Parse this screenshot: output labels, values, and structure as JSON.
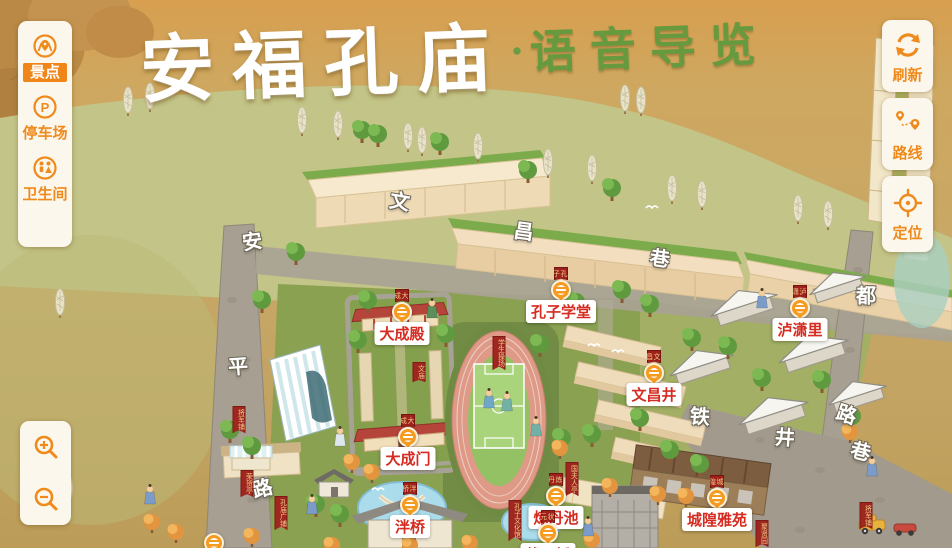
{
  "title": {
    "main": "安福孔庙",
    "separator": "·",
    "sub": "语音导览"
  },
  "colors": {
    "accent_orange": "#f08519",
    "poi_text_red": "#d52b20",
    "banner_red": "#9e211b",
    "title_white": "#ffffff",
    "title_green": "#679a3e",
    "paper_tan": "#c8a866"
  },
  "sidebar": {
    "items": [
      {
        "id": "scenic",
        "label": "景点",
        "icon": "scenic-spot-icon",
        "active": true
      },
      {
        "id": "parking",
        "label": "停车场",
        "icon": "parking-icon",
        "active": false
      },
      {
        "id": "restroom",
        "label": "卫生间",
        "icon": "restroom-icon",
        "active": false
      }
    ]
  },
  "right_controls": [
    {
      "id": "refresh",
      "label": "刷新",
      "icon": "refresh-icon"
    },
    {
      "id": "route",
      "label": "路线",
      "icon": "route-icon"
    },
    {
      "id": "locate",
      "label": "定位",
      "icon": "locate-icon"
    }
  ],
  "zoom_controls": {
    "zoom_in": "zoom-in-icon",
    "zoom_out": "zoom-out-icon"
  },
  "map": {
    "pois": [
      {
        "id": "dachengdian",
        "name": "大成殿",
        "x": 402,
        "y": 312
      },
      {
        "id": "kongzixuetang",
        "name": "孔子学堂",
        "x": 561,
        "y": 290
      },
      {
        "id": "luxiaoli",
        "name": "泸潇里",
        "x": 800,
        "y": 308
      },
      {
        "id": "wenchangjing",
        "name": "文昌井",
        "x": 654,
        "y": 373
      },
      {
        "id": "dachengmen",
        "name": "大成门",
        "x": 408,
        "y": 437
      },
      {
        "id": "panqiao",
        "name": "泮桥",
        "x": 410,
        "y": 505
      },
      {
        "id": "liandanchi",
        "name": "炼丹池",
        "x": 556,
        "y": 496
      },
      {
        "id": "zhuangyuanqiao",
        "name": "状元桥",
        "x": 548,
        "y": 533
      },
      {
        "id": "chenghuangyayuan",
        "name": "城隍雅苑",
        "x": 717,
        "y": 498
      },
      {
        "id": "poi-bottom-left",
        "name": "",
        "x": 214,
        "y": 543
      }
    ],
    "street_labels": [
      {
        "text": "安",
        "x": 252,
        "y": 240,
        "rot": -8
      },
      {
        "text": "平",
        "x": 238,
        "y": 365,
        "rot": -4
      },
      {
        "text": "路",
        "x": 262,
        "y": 487,
        "rot": -14
      },
      {
        "text": "文",
        "x": 400,
        "y": 200,
        "rot": 10
      },
      {
        "text": "昌",
        "x": 524,
        "y": 230,
        "rot": 8
      },
      {
        "text": "巷",
        "x": 660,
        "y": 257,
        "rot": 8
      },
      {
        "text": "铁",
        "x": 700,
        "y": 415,
        "rot": 4
      },
      {
        "text": "井",
        "x": 785,
        "y": 436,
        "rot": 4
      },
      {
        "text": "路",
        "x": 847,
        "y": 413,
        "rot": 18
      },
      {
        "text": "巷",
        "x": 861,
        "y": 450,
        "rot": 14
      },
      {
        "text": "都",
        "x": 866,
        "y": 294,
        "rot": 0
      }
    ],
    "mini_banners": [
      {
        "text": "将军铺",
        "x": 239,
        "y": 406
      },
      {
        "text": "荣贺亭",
        "x": 247,
        "y": 470
      },
      {
        "text": "孔庙广铺",
        "x": 281,
        "y": 496
      },
      {
        "text": "孔子文化馆",
        "x": 515,
        "y": 500
      },
      {
        "text": "文庙",
        "x": 419,
        "y": 362
      },
      {
        "text": "学生操场",
        "x": 499,
        "y": 336
      },
      {
        "text": "国夫人亭",
        "x": 572,
        "y": 462
      },
      {
        "text": "聚贤园",
        "x": 762,
        "y": 520
      },
      {
        "text": "将军铺",
        "x": 866,
        "y": 502
      }
    ]
  }
}
